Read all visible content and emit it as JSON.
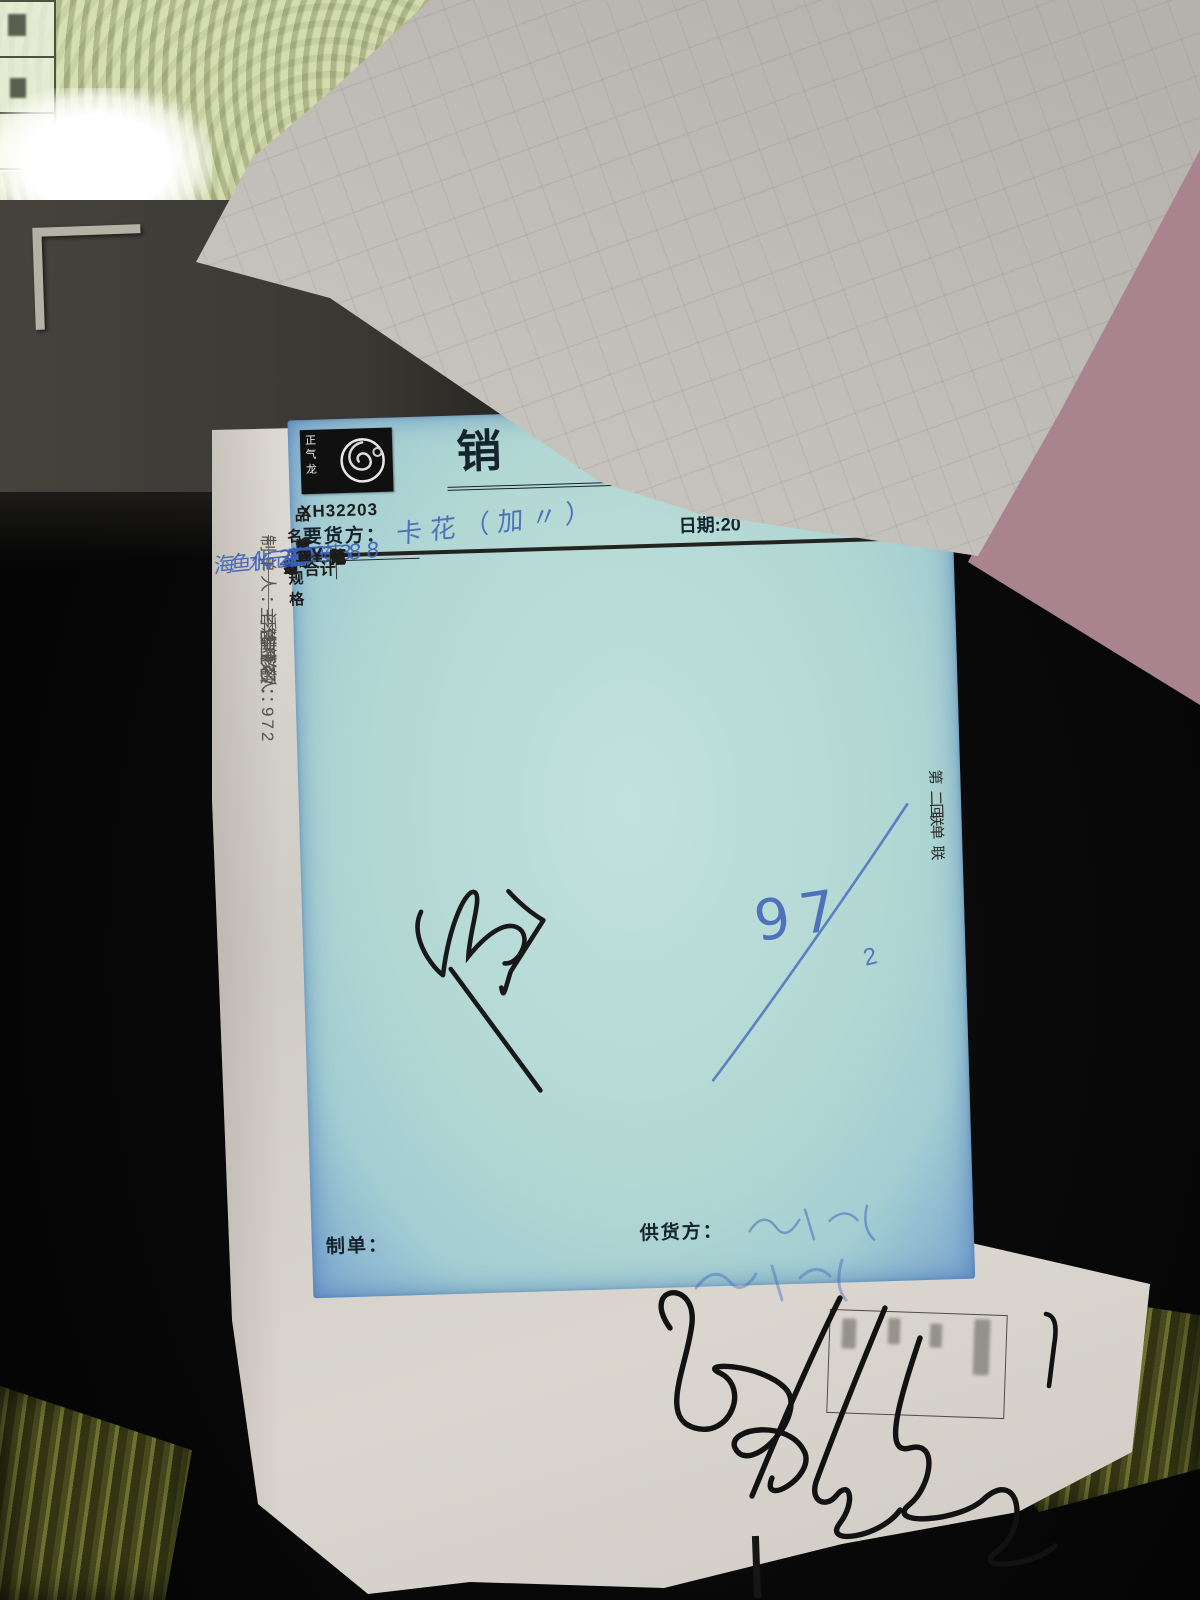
{
  "scene": {
    "background_color": "#070707",
    "invoice_paper_color": "#b2d8d4",
    "invoice_edge_tint": "#7fa9cf",
    "under_paper_color": "#d6d3cc",
    "fold_paper_color": "#d0cdc7",
    "carbon_pink_color": "#a9838d",
    "mat_green_color": "#b3bc92",
    "ink_blue": "#3d61b6",
    "ink_black": "#161616"
  },
  "form": {
    "brand": "正气龙",
    "serial": "XH32203",
    "title_visible": "销 货",
    "buyer_label": "要货方：",
    "buyer_handwritten": "卡花（加〃）",
    "date_label": "日期:20",
    "copy_label_part1": "第二联",
    "copy_label_part2": "回单联",
    "table": {
      "headers": {
        "seq": "序\n号",
        "name": "品名及规格",
        "unit": "单\n位",
        "qty": "数量",
        "price": "单价",
        "amount": "金额"
      },
      "row_count": 17,
      "entries": [
        {
          "no": "1",
          "name": "佧花茹",
          "unit": "口",
          "qty": "15",
          "price": "15",
          "amount": "225"
        },
        {
          "no": "2",
          "name": "海水晶 38",
          "unit": "口",
          "qty": "10",
          "price": "39",
          "amount": "390"
        },
        {
          "no": "3",
          "name": "鱼元 38",
          "unit": "斤",
          "qty": "21",
          "price": "17",
          "amount": "357"
        }
      ]
    },
    "sum_row": {
      "label": "合计",
      "digits": [
        "拾",
        "万",
        "仟",
        "佰",
        "拾",
        "元",
        "角",
        "分"
      ],
      "currency": "¥"
    },
    "footer": {
      "maker_label": "制单：",
      "supplier_label": "供货方："
    },
    "handwritten_total": "97",
    "handwritten_total_sub": "2"
  },
  "margin_notes": {
    "maker": "制单人：季佳欣",
    "auditor": "审核人：",
    "manager": "主管签名：",
    "total": "总金额：972"
  }
}
